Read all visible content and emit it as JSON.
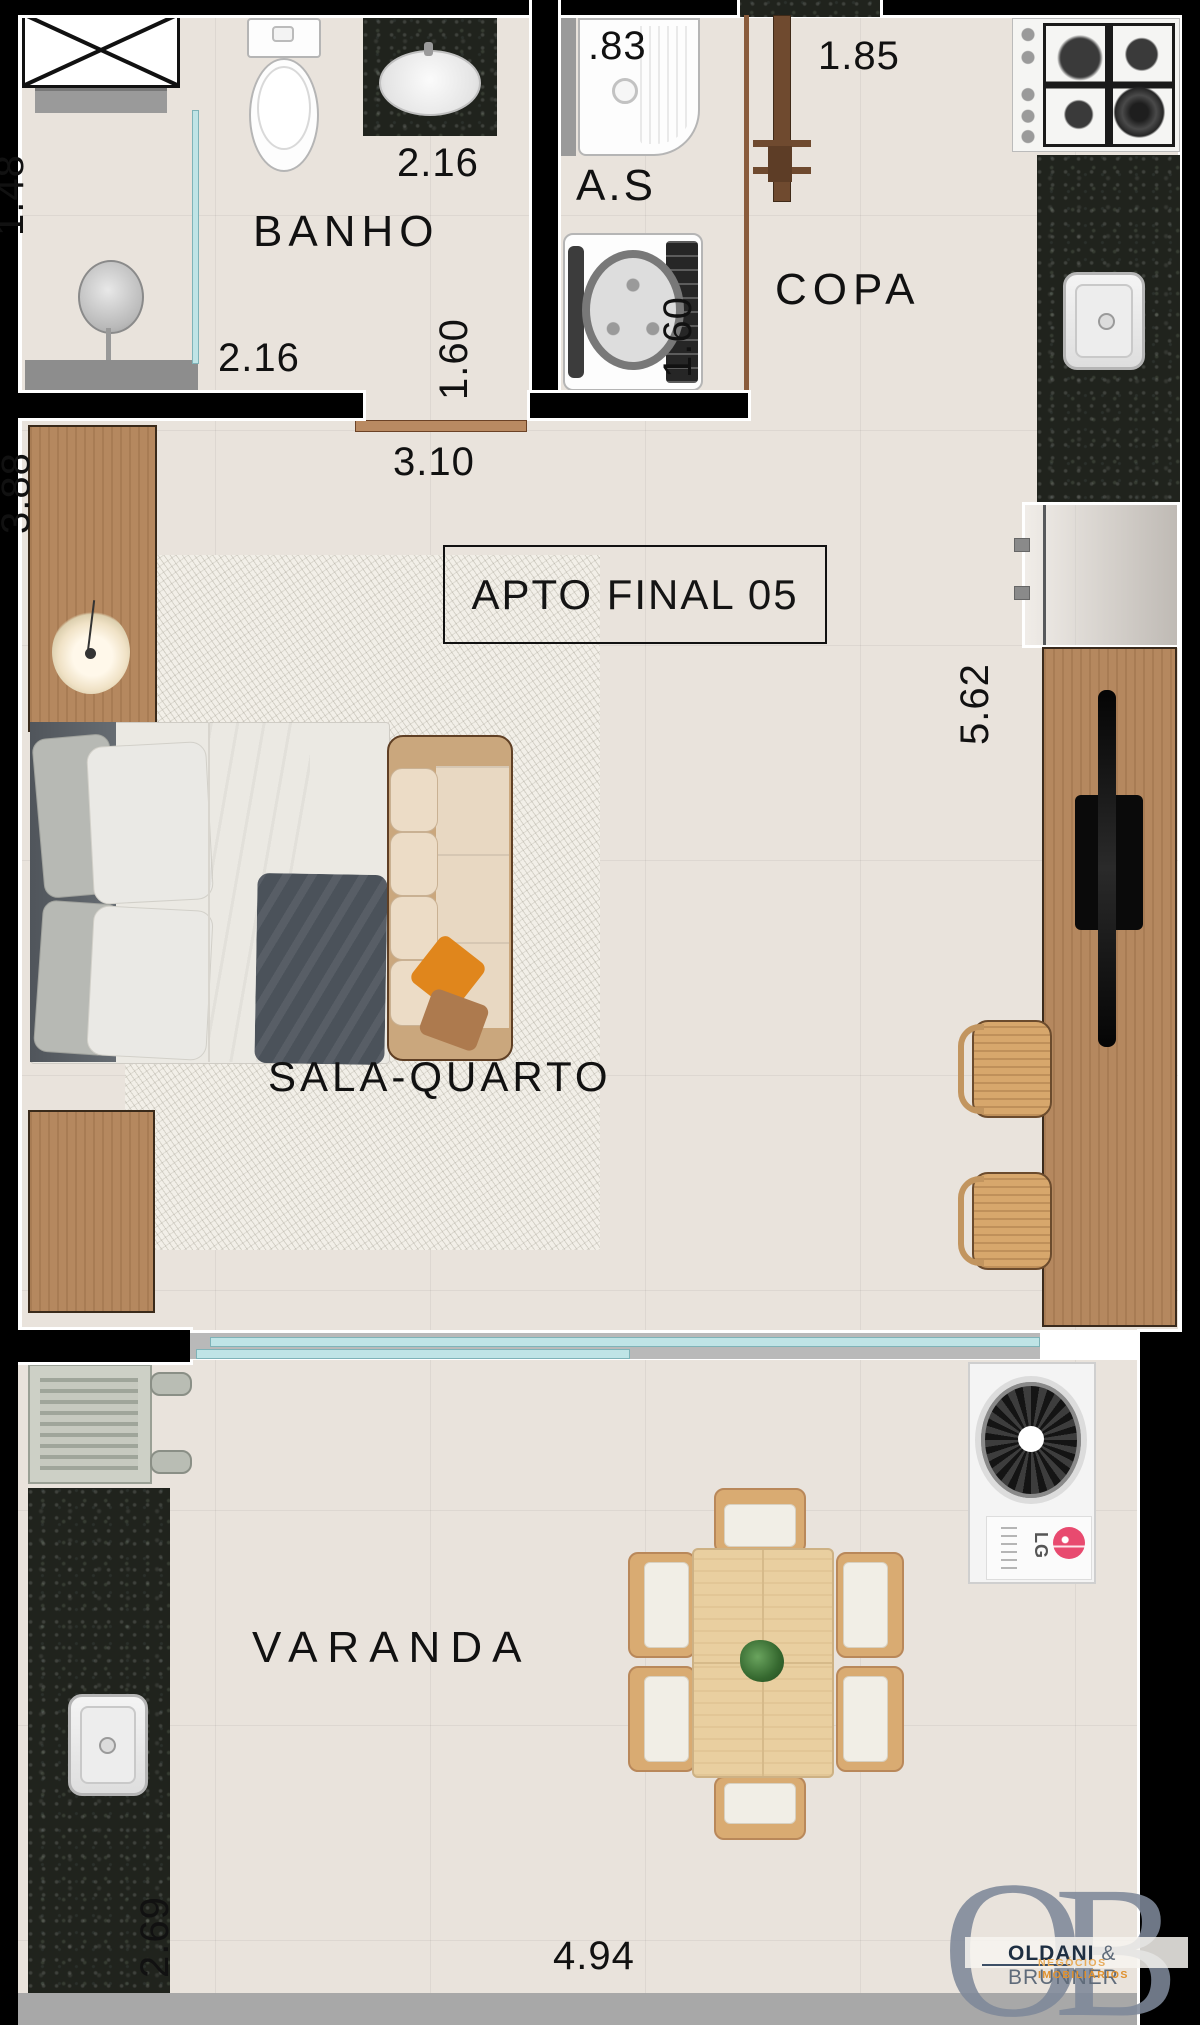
{
  "title": "APTO FINAL 05",
  "rooms": {
    "banho": {
      "name": "BANHO",
      "dim_top": "2.16",
      "dim_bottom": "2.16",
      "dim_right": "1.60",
      "dim_shower": "1.48"
    },
    "servico": {
      "name": "A.S",
      "dim_tanque": ".83"
    },
    "copa": {
      "name": "COPA",
      "dim_top": "1.85",
      "dim_left": "1.60"
    },
    "sala": {
      "name": "SALA-QUARTO",
      "dim_door": "3.10",
      "dim_left": "3.88",
      "dim_right": "5.62"
    },
    "varanda": {
      "name": "VARANDA",
      "dim_left": "2.69",
      "dim_bottom": "4.94"
    }
  },
  "ac_unit": {
    "brand": "LG"
  },
  "logo": {
    "monogram_left": "O",
    "monogram_right": "B",
    "name_primary": "OLDANI",
    "name_secondary": "& BRUNNER",
    "tagline_word1": "NEGÓCIOS",
    "tagline_word2": "IMOBILIÁRIOS"
  },
  "colors": {
    "floor": "#e9e3dc",
    "wall": "#000000",
    "granite": "#20231d",
    "wood": "#b5885f",
    "light_wood": "#e9cfa0",
    "glass": "#bfe4e6",
    "door": "#6f4a2f",
    "logo_monogram": "#7d8798",
    "logo_tagline": "#e0912e",
    "lg_badge": "#e84a6f"
  }
}
